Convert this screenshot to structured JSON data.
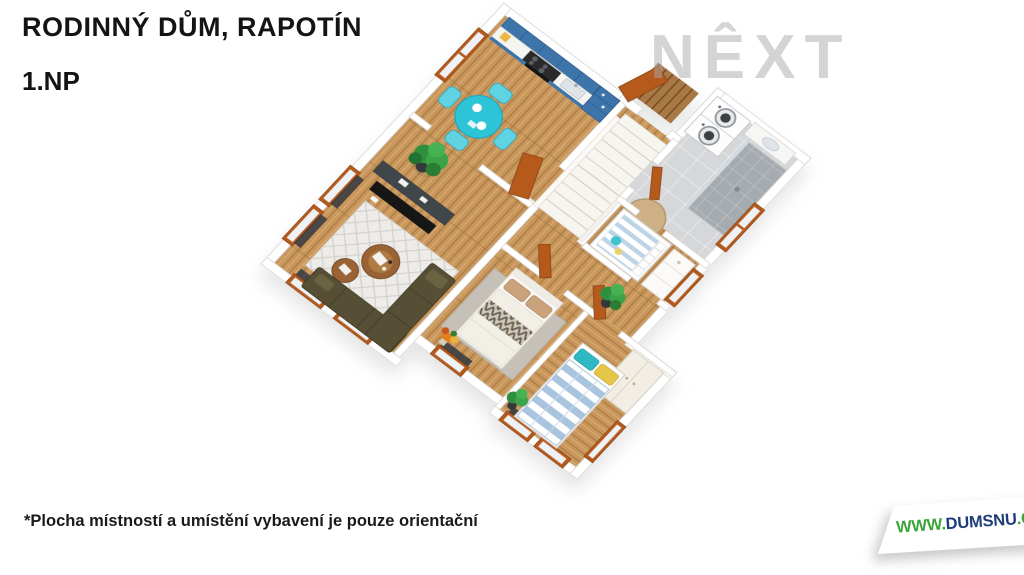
{
  "header": {
    "title": "RODINNÝ DŮM, RAPOTÍN",
    "floor_label": "1.NP"
  },
  "footer": {
    "disclaimer": "*Plocha místností a umístění vybavení je pouze orientační"
  },
  "watermark": {
    "text": "NÊXT"
  },
  "logo": {
    "prefix": "WWW.",
    "name": "DUMSNU",
    "suffix": ".COM",
    "prefix_color": "#3ba53a",
    "name_color": "#1d3b78"
  },
  "floorplan": {
    "type": "3d-top-down-render",
    "palette": {
      "wood_floor": "#c9975c",
      "door_orange": "#b65a1d",
      "cabinet_blue": "#3e74ab",
      "table_teal": "#2ec4d7",
      "sofa_olive": "#565035",
      "tile_gray": "#d6d7d9",
      "shower_gray": "#a6abb0",
      "wall_white": "#ffffff",
      "rug_jute": "#cdb085",
      "duvet_blue": "#a9c4df",
      "pillow_teal": "#2fb9c4",
      "pillow_yellow": "#e5c648"
    },
    "rooms": [
      {
        "id": "kitchen-dining",
        "furniture": [
          "blue-cabinet-run",
          "cooktop",
          "oven",
          "sink",
          "tall-cabinet",
          "round-teal-table",
          "four-teal-chairs",
          "west-window"
        ]
      },
      {
        "id": "entry-stair-hall",
        "furniture": [
          "staircase",
          "entry-door",
          "outdoor-deck-mat"
        ]
      },
      {
        "id": "bathroom-laundry",
        "furniture": [
          "stacked-washer-dryer",
          "counter-sink",
          "tiled-shower",
          "jute-rug"
        ]
      },
      {
        "id": "nursery-landing",
        "furniture": [
          "crib-striped-mattress",
          "changing-dresser",
          "east-window"
        ]
      },
      {
        "id": "hallway",
        "furniture": [
          "potted-plant",
          "bedroom-doors"
        ]
      },
      {
        "id": "living-room",
        "furniture": [
          "wall-tv",
          "media-console",
          "lattice-rug",
          "two-round-coffee-tables",
          "olive-sofa",
          "potted-plant",
          "windows"
        ]
      },
      {
        "id": "bedroom-1",
        "furniture": [
          "double-bed-white",
          "zigzag-throw",
          "tan-pillows",
          "gray-rug",
          "flower-bouquet",
          "south-window"
        ]
      },
      {
        "id": "bedroom-2",
        "furniture": [
          "bed-blue-striped-duvet",
          "teal-pillow",
          "yellow-pillow",
          "wardrobe",
          "south-windows"
        ]
      }
    ]
  }
}
